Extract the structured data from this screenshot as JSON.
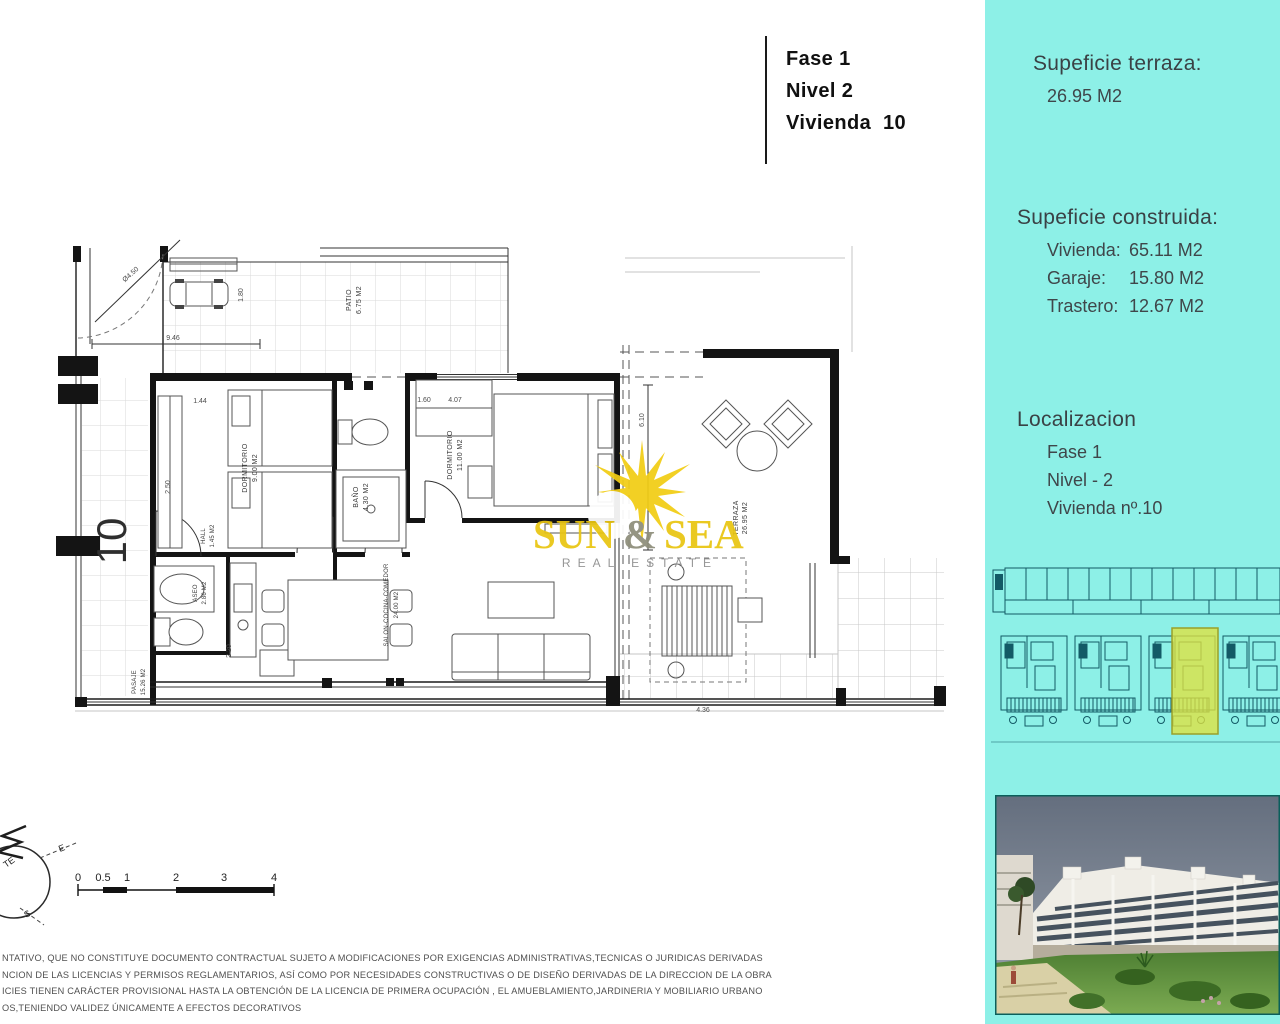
{
  "title_block": {
    "lines": [
      "Fase 1",
      "Nivel 2",
      "Vivienda  10"
    ]
  },
  "sidebar": {
    "terraza_heading": "Supeficie terraza:",
    "terraza_value": "26.95 M2",
    "construida_heading": "Supeficie construida:",
    "construida_items": [
      {
        "label": "Vivienda:",
        "value": "65.11 M2"
      },
      {
        "label": "Garaje:",
        "value": "15.80 M2"
      },
      {
        "label": "Trastero:",
        "value": "12.67 M2"
      }
    ],
    "localizacion_heading": "Localizacion",
    "localizacion_lines": [
      "Fase 1",
      "Nivel - 2",
      "Vivienda nº.10"
    ]
  },
  "plan": {
    "unit_number": "10",
    "rooms": [
      {
        "label": "PATIO",
        "area": "6.75 M2"
      },
      {
        "label": "DORMITORIO",
        "area": "9.00 M2"
      },
      {
        "label": "BAÑO",
        "area": "4.30 M2"
      },
      {
        "label": "DORMITORIO",
        "area": "11.00 M2"
      },
      {
        "label": "SALON-COCINA-COMEDOR",
        "area": "24.00 M2"
      },
      {
        "label": "ASEO",
        "area": "2.86 M2"
      },
      {
        "label": "HALL",
        "area": "1.45 M2"
      },
      {
        "label": "TERRAZA",
        "area": "26.95 M2"
      },
      {
        "label": "PASAJE",
        "area": "15.26 M2"
      }
    ],
    "dims": [
      "9.46",
      "1.80",
      "Ø4.50",
      "1.44",
      "2.50",
      "1.60",
      "4.07",
      "6.10",
      "2.20",
      "4.36"
    ]
  },
  "watermark": {
    "word1": "SUN",
    "amp": "&",
    "word2": "SEA",
    "subtitle": "REAL ESTATE"
  },
  "scale_bar": {
    "ticks": [
      "0",
      "0.5",
      "1",
      "2",
      "3",
      "4"
    ]
  },
  "compass": {
    "letters": [
      "TE",
      "E",
      "S"
    ]
  },
  "disclaimer": {
    "lines": [
      "NTATIVO, QUE NO CONSTITUYE DOCUMENTO CONTRACTUAL SUJETO A MODIFICACIONES  POR EXIGENCIAS ADMINISTRATIVAS,TECNICAS O JURIDICAS DERIVADAS",
      "NCION DE LAS LICENCIAS Y PERMISOS REGLAMENTARIOS, ASÍ COMO POR NECESIDADES CONSTRUCTIVAS  O DE DISEÑO DERIVADAS DE LA DIRECCION DE LA OBRA",
      "ICIES TIENEN CARÁCTER PROVISIONAL HASTA LA OBTENCIÓN DE LA LICENCIA DE PRIMERA OCUPACIÓN , EL AMUEBLAMIENTO,JARDINERIA Y MOBILIARIO URBANO",
      "OS,TENIENDO VALIDEZ ÚNICAMENTE  A EFECTOS DECORATIVOS"
    ]
  },
  "colors": {
    "panel_cyan": "#8DF0E7",
    "highlight_yellow": "#DFE23F",
    "logo_yellow": "#E9C512",
    "plan_line": "#1c1c1c",
    "siteplan_line": "#135A66"
  }
}
